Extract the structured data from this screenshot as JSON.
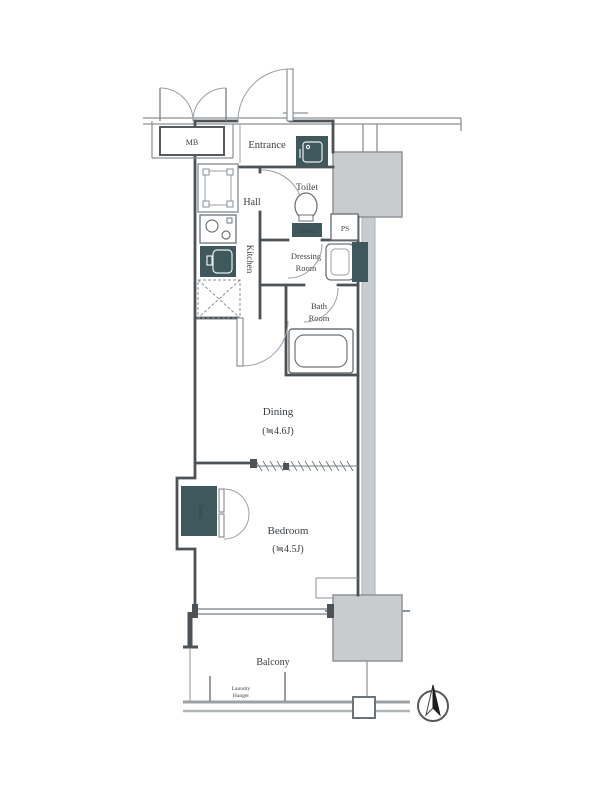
{
  "meta": {
    "type": "apartment-floor-plan"
  },
  "colors": {
    "wall": "#4d5257",
    "fixture_dark": "#3e585c",
    "block_gray": "#c9cccf",
    "line_gray": "#8b9194",
    "text": "#3a3f43"
  },
  "labels": {
    "meter_box": "MB",
    "entrance": "Entrance",
    "hall": "Hall",
    "toilet": "Toilet",
    "toilet_badge": "CF/Wa",
    "kitchen": "Kitchen",
    "pipe_space": "PS",
    "dressing_room": {
      "line1": "Dressing",
      "line2": "Room"
    },
    "bath_room": {
      "line1": "Bath",
      "line2": "Room"
    },
    "dining": {
      "name": "Dining",
      "size": "(≒4.6J)"
    },
    "bedroom": {
      "name": "Bedroom",
      "size": "(≒4.5J)"
    },
    "closet": "Closet",
    "balcony": "Balcony",
    "laundry_hanger": {
      "line1": "Laundry",
      "line2": "Hanger"
    }
  }
}
